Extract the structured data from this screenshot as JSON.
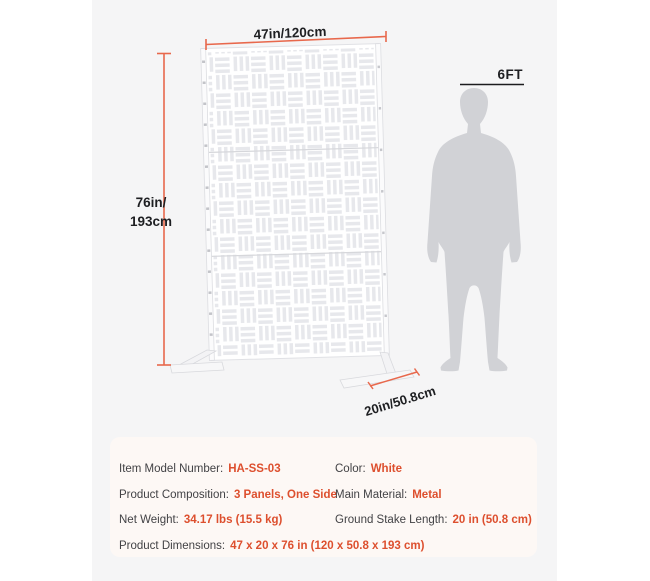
{
  "colors": {
    "accent_value_text": "#dd4f2e",
    "dimension_line": "#e8684c",
    "canvas_background": "#f5f5f6",
    "spec_card_background": "#fdf8f5",
    "panel_white": "#ffffff",
    "panel_pattern_gray": "#e7e8ec",
    "silhouette_gray": "#d1d2d6",
    "label_text": "#1e1f22"
  },
  "diagram": {
    "width_label": "47in/120cm",
    "height_label": "76in/\n193cm",
    "depth_label": "20in/50.8cm",
    "person_height_label": "6FT"
  },
  "specs": {
    "rows": [
      {
        "label": "Item Model Number:",
        "value": "HA-SS-03"
      },
      {
        "label": "Color:",
        "value": "White"
      },
      {
        "label": "Product Composition:",
        "value": "3 Panels, One Side"
      },
      {
        "label": "Main Material:",
        "value": "Metal"
      },
      {
        "label": "Net Weight:",
        "value": "34.17 lbs (15.5 kg)"
      },
      {
        "label": "Ground Stake Length:",
        "value": "20 in (50.8 cm)"
      },
      {
        "label": "Product Dimensions:",
        "value": "47 x 20 x 76 in (120 x 50.8 x 193 cm)"
      }
    ]
  }
}
